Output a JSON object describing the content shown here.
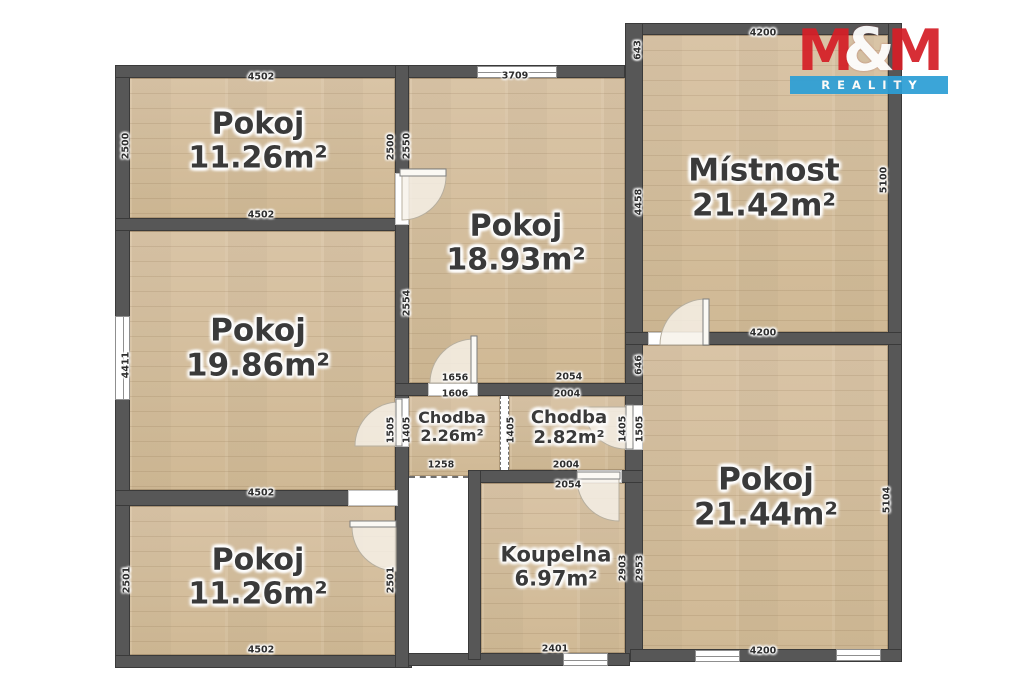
{
  "logo": {
    "m1": "M",
    "amp": "&",
    "m2": "M",
    "reality": "REALITY",
    "red": "#d51f27",
    "blue": "#2d9fd6"
  },
  "rooms": [
    {
      "name": "Pokoj",
      "area": "11.26m²",
      "x": 258,
      "y": 141,
      "size": 30
    },
    {
      "name": "Pokoj",
      "area": "18.93m²",
      "x": 516,
      "y": 243,
      "size": 30
    },
    {
      "name": "Místnost",
      "area": "21.42m²",
      "x": 764,
      "y": 188,
      "size": 31
    },
    {
      "name": "Pokoj",
      "area": "19.86m²",
      "x": 258,
      "y": 348,
      "size": 31
    },
    {
      "name": "Chodba",
      "area": "2.26m²",
      "x": 452,
      "y": 427,
      "size": 16
    },
    {
      "name": "Chodba",
      "area": "2.82m²",
      "x": 569,
      "y": 428,
      "size": 18
    },
    {
      "name": "Pokoj",
      "area": "21.44m²",
      "x": 766,
      "y": 497,
      "size": 31
    },
    {
      "name": "Pokoj",
      "area": "11.26m²",
      "x": 258,
      "y": 577,
      "size": 30
    },
    {
      "name": "Koupelna",
      "area": "6.97m²",
      "x": 556,
      "y": 567,
      "size": 21
    }
  ],
  "dimensions": [
    {
      "label": "4502",
      "x": 261,
      "y": 77,
      "vertical": false
    },
    {
      "label": "3709",
      "x": 515,
      "y": 76,
      "vertical": false
    },
    {
      "label": "4200",
      "x": 763,
      "y": 33,
      "vertical": false
    },
    {
      "label": "4502",
      "x": 261,
      "y": 215,
      "vertical": false
    },
    {
      "label": "1656",
      "x": 455,
      "y": 378,
      "vertical": false
    },
    {
      "label": "2054",
      "x": 569,
      "y": 377,
      "vertical": false
    },
    {
      "label": "1606",
      "x": 455,
      "y": 394,
      "vertical": false
    },
    {
      "label": "2004",
      "x": 567,
      "y": 394,
      "vertical": false
    },
    {
      "label": "4200",
      "x": 763,
      "y": 333,
      "vertical": false
    },
    {
      "label": "1258",
      "x": 441,
      "y": 465,
      "vertical": false
    },
    {
      "label": "2004",
      "x": 566,
      "y": 465,
      "vertical": false
    },
    {
      "label": "2054",
      "x": 568,
      "y": 485,
      "vertical": false
    },
    {
      "label": "4502",
      "x": 261,
      "y": 493,
      "vertical": false
    },
    {
      "label": "2401",
      "x": 555,
      "y": 649,
      "vertical": false
    },
    {
      "label": "4502",
      "x": 261,
      "y": 650,
      "vertical": false
    },
    {
      "label": "4200",
      "x": 763,
      "y": 651,
      "vertical": false
    },
    {
      "label": "2500",
      "x": 126,
      "y": 146,
      "vertical": true
    },
    {
      "label": "2500",
      "x": 391,
      "y": 147,
      "vertical": true
    },
    {
      "label": "2550",
      "x": 407,
      "y": 146,
      "vertical": true
    },
    {
      "label": "643",
      "x": 638,
      "y": 50,
      "vertical": true
    },
    {
      "label": "4458",
      "x": 639,
      "y": 202,
      "vertical": true
    },
    {
      "label": "5100",
      "x": 884,
      "y": 180,
      "vertical": true
    },
    {
      "label": "2554",
      "x": 407,
      "y": 303,
      "vertical": true
    },
    {
      "label": "4411",
      "x": 126,
      "y": 365,
      "vertical": true
    },
    {
      "label": "1505",
      "x": 391,
      "y": 430,
      "vertical": true
    },
    {
      "label": "1405",
      "x": 407,
      "y": 430,
      "vertical": true
    },
    {
      "label": "1405",
      "x": 511,
      "y": 430,
      "vertical": true
    },
    {
      "label": "1405",
      "x": 623,
      "y": 429,
      "vertical": true
    },
    {
      "label": "1505",
      "x": 640,
      "y": 429,
      "vertical": true
    },
    {
      "label": "646",
      "x": 639,
      "y": 365,
      "vertical": true
    },
    {
      "label": "2903",
      "x": 623,
      "y": 568,
      "vertical": true
    },
    {
      "label": "2953",
      "x": 640,
      "y": 568,
      "vertical": true
    },
    {
      "label": "5104",
      "x": 887,
      "y": 500,
      "vertical": true
    },
    {
      "label": "2501",
      "x": 127,
      "y": 580,
      "vertical": true
    },
    {
      "label": "2501",
      "x": 391,
      "y": 580,
      "vertical": true
    }
  ]
}
